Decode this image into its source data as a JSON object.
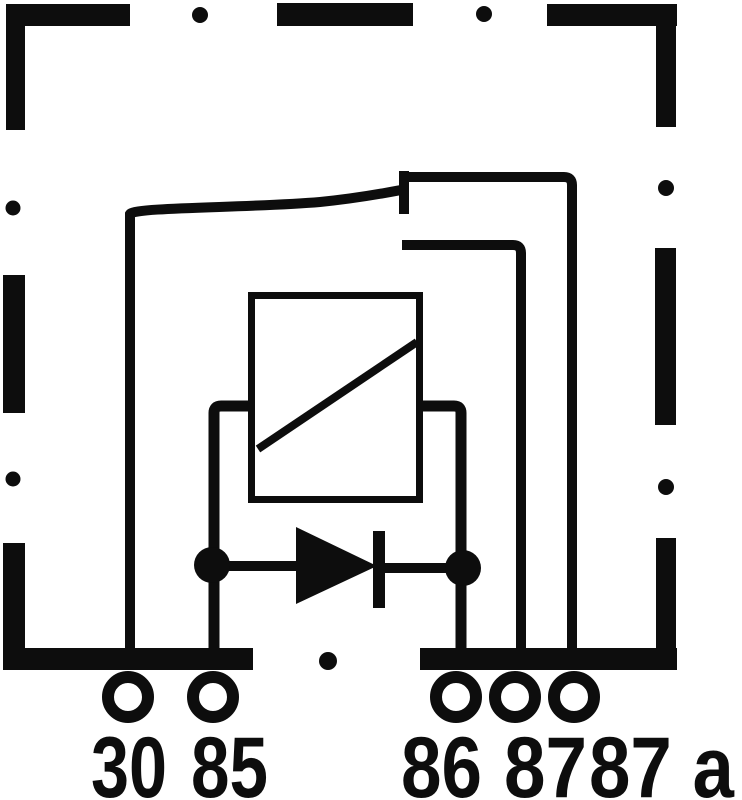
{
  "diagram": {
    "kind": "relay-circuit-schematic",
    "colors": {
      "ink": "#0d0d0d",
      "background": "#ffffff"
    },
    "components": [
      "dashed-housing-frame",
      "relay-coil",
      "suppression-diode",
      "changeover-contact"
    ],
    "terminals": [
      {
        "id": "30",
        "label": "30"
      },
      {
        "id": "85",
        "label": "85"
      },
      {
        "id": "86",
        "label": "86"
      },
      {
        "id": "87",
        "label": "87"
      },
      {
        "id": "87a",
        "label": "87 a"
      }
    ]
  }
}
